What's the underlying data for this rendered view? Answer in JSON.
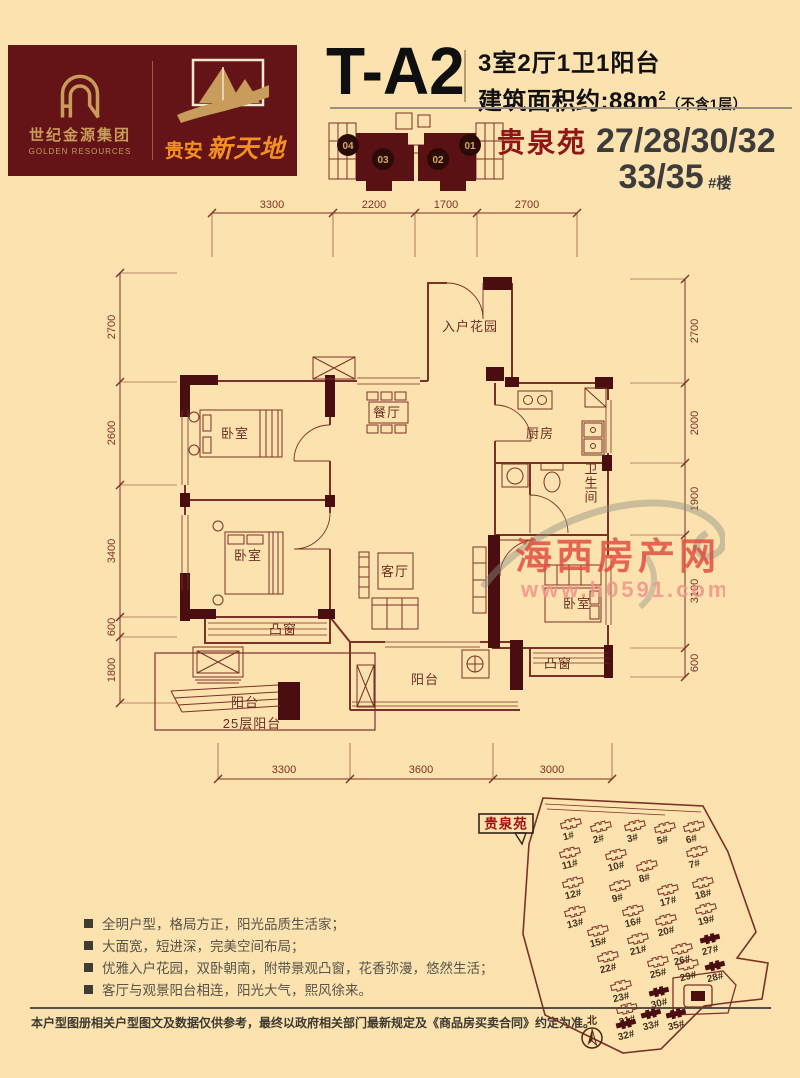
{
  "colors": {
    "line": "#7c3128",
    "wall": "#4a0d10",
    "accent_red": "#8e1617",
    "gold": "#c89c5a",
    "orange": "#f29120",
    "maroon": "#641417"
  },
  "header": {
    "logo": {
      "monogram": "GR",
      "company_cn": "世纪金源集团",
      "company_en": "GOLDEN RESOURCES",
      "brand_prefix": "贵安",
      "brand_name": "新天地"
    },
    "unit_code": "T-A2",
    "layout_line": "3室2厅1卫1阳台",
    "area_prefix": "建筑面积约:",
    "area_value": "88",
    "area_unit": "m",
    "area_sup": "2",
    "area_note": "（不含1层）",
    "keyplan_units": [
      "04",
      "03",
      "02",
      "01"
    ],
    "court_name": "贵泉苑",
    "buildings_line1": "27/28/30/32",
    "buildings_line2": "33/35",
    "building_suffix": "#楼"
  },
  "plan": {
    "dims": {
      "top": [
        "3300",
        "2200",
        "1700",
        "2700"
      ],
      "left": [
        "2700",
        "2600",
        "3400",
        "600",
        "1800"
      ],
      "right": [
        "2700",
        "2000",
        "1900",
        "3100",
        "600"
      ],
      "bottom": [
        "3300",
        "3600",
        "3000"
      ]
    },
    "rooms": {
      "entry_garden": "入户花园",
      "dining": "餐厅",
      "kitchen": "厨房",
      "bathroom": "卫生间",
      "bedroom": "卧室",
      "living": "客厅",
      "bay_window": "凸窗",
      "balcony": "阳台",
      "balcony_note": "25层阳台"
    }
  },
  "watermark": {
    "title": "海西房产网",
    "url": "www.h0591.com"
  },
  "features": [
    "全明户型，格局方正，阳光品质生活家；",
    "大面宽，短进深，完美空间布局；",
    "优雅入户花园，双卧朝南，附带景观凸窗，花香弥漫，悠然生活；",
    "客厅与观景阳台相连，阳光大气，熙风徐来。"
  ],
  "disclaimer": "本户型图册相关户型图文及数据仅供参考，最终以政府相关部门最新规定及《商品房买卖合同》约定为准。",
  "siteplan": {
    "label": "贵泉苑",
    "compass": "北",
    "highlighted": [
      "27#",
      "28#",
      "30#",
      "32#",
      "33#",
      "35#"
    ],
    "buildings": [
      {
        "name": "1#",
        "x": 107,
        "y": 46
      },
      {
        "name": "2#",
        "x": 137,
        "y": 49
      },
      {
        "name": "3#",
        "x": 171,
        "y": 48
      },
      {
        "name": "5#",
        "x": 201,
        "y": 50
      },
      {
        "name": "6#",
        "x": 230,
        "y": 49
      },
      {
        "name": "7#",
        "x": 233,
        "y": 74
      },
      {
        "name": "8#",
        "x": 183,
        "y": 88
      },
      {
        "name": "10#",
        "x": 152,
        "y": 77
      },
      {
        "name": "11#",
        "x": 106,
        "y": 75
      },
      {
        "name": "12#",
        "x": 109,
        "y": 105
      },
      {
        "name": "9#",
        "x": 156,
        "y": 108
      },
      {
        "name": "17#",
        "x": 204,
        "y": 112
      },
      {
        "name": "18#",
        "x": 239,
        "y": 105
      },
      {
        "name": "13#",
        "x": 111,
        "y": 134
      },
      {
        "name": "16#",
        "x": 169,
        "y": 133
      },
      {
        "name": "19#",
        "x": 242,
        "y": 131
      },
      {
        "name": "15#",
        "x": 134,
        "y": 153
      },
      {
        "name": "20#",
        "x": 202,
        "y": 142
      },
      {
        "name": "21#",
        "x": 174,
        "y": 161
      },
      {
        "name": "27#",
        "x": 246,
        "y": 161
      },
      {
        "name": "22#",
        "x": 144,
        "y": 179
      },
      {
        "name": "26#",
        "x": 218,
        "y": 171
      },
      {
        "name": "25#",
        "x": 194,
        "y": 184
      },
      {
        "name": "29#",
        "x": 224,
        "y": 187
      },
      {
        "name": "28#",
        "x": 251,
        "y": 188
      },
      {
        "name": "23#",
        "x": 157,
        "y": 208
      },
      {
        "name": "30#",
        "x": 195,
        "y": 214
      },
      {
        "name": "31#",
        "x": 163,
        "y": 231
      },
      {
        "name": "33#",
        "x": 187,
        "y": 236
      },
      {
        "name": "35#",
        "x": 212,
        "y": 236
      },
      {
        "name": "32#",
        "x": 162,
        "y": 246
      }
    ]
  }
}
